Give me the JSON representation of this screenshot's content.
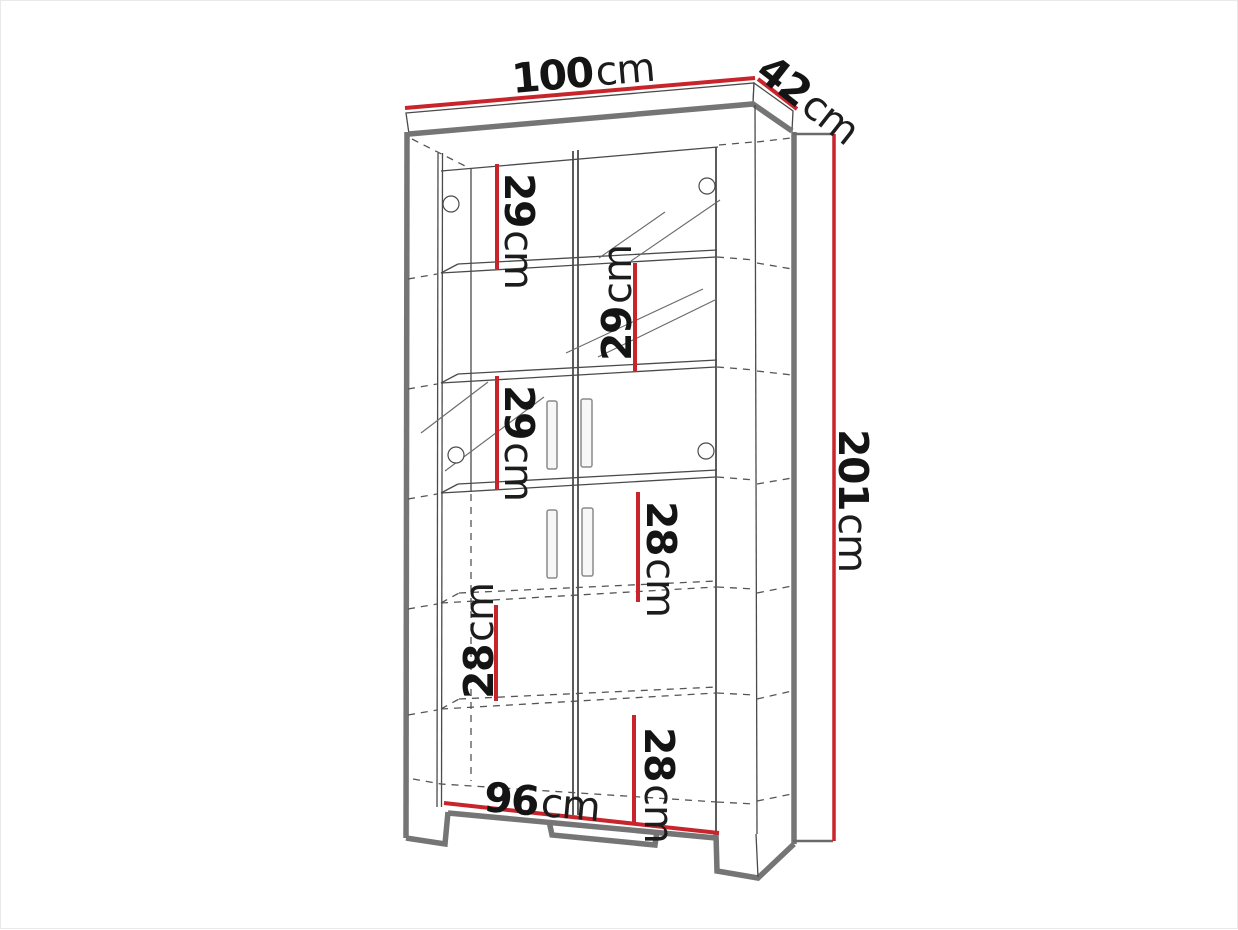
{
  "colors": {
    "dimension_red": "#c8242c",
    "outline_gray": "#757575",
    "line_dark": "#4a4a4a",
    "text_black": "#141414"
  },
  "labels": {
    "top_width": {
      "value": "100",
      "unit": "cm"
    },
    "top_depth": {
      "value": "42",
      "unit": "cm"
    },
    "right_height": {
      "value": "201",
      "unit": "cm"
    },
    "bottom_width": {
      "value": "96",
      "unit": "cm"
    },
    "sections": [
      {
        "value": "29",
        "unit": "cm"
      },
      {
        "value": "29",
        "unit": "cm"
      },
      {
        "value": "29",
        "unit": "cm"
      },
      {
        "value": "28",
        "unit": "cm"
      },
      {
        "value": "28",
        "unit": "cm"
      },
      {
        "value": "28",
        "unit": "cm"
      }
    ]
  }
}
